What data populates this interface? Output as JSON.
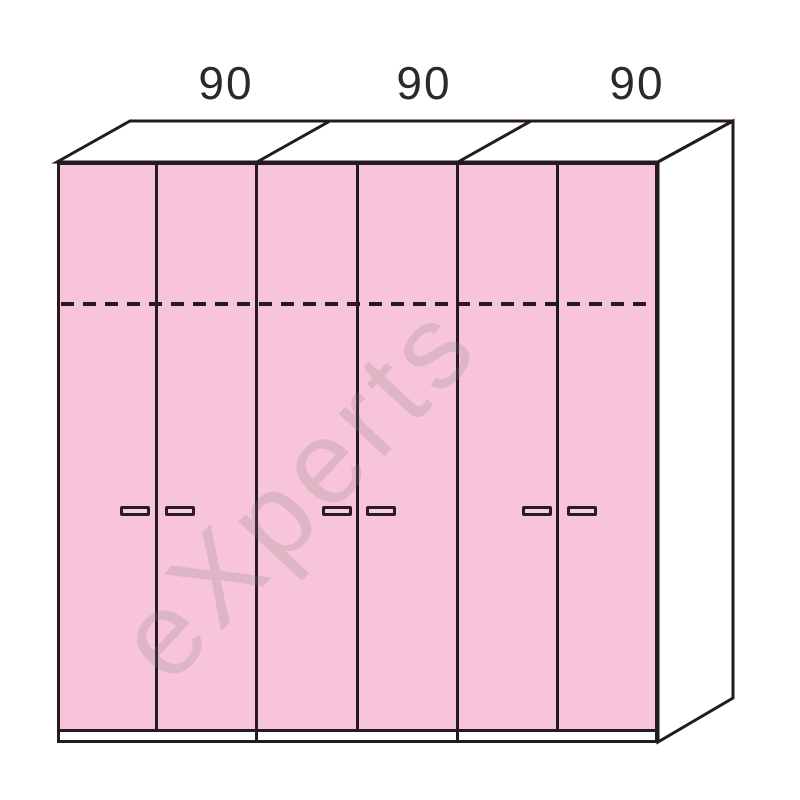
{
  "drawing": {
    "type": "wardrobe front 3d elevation drawing",
    "sections": [
      {
        "width_label": "90"
      },
      {
        "width_label": "90"
      },
      {
        "width_label": "90"
      }
    ],
    "sections_count": 3,
    "doors_count": 6,
    "doors_per_section": 2,
    "handles_count": 6,
    "features": {
      "dashed_internal_line": "horizontal dashed shelf line across all doors",
      "plinth": "white base strip under doors",
      "perspective": "top and right side faces shown in white"
    },
    "watermark": {
      "text": "eXperts"
    },
    "colors": {
      "door_fill": "#F8C4D9",
      "outline": "#241A22",
      "handle_fill": "#F6D0E0",
      "background": "#FFFFFF",
      "label_text": "#2A2A2A",
      "watermark_gray": "#808080"
    }
  }
}
